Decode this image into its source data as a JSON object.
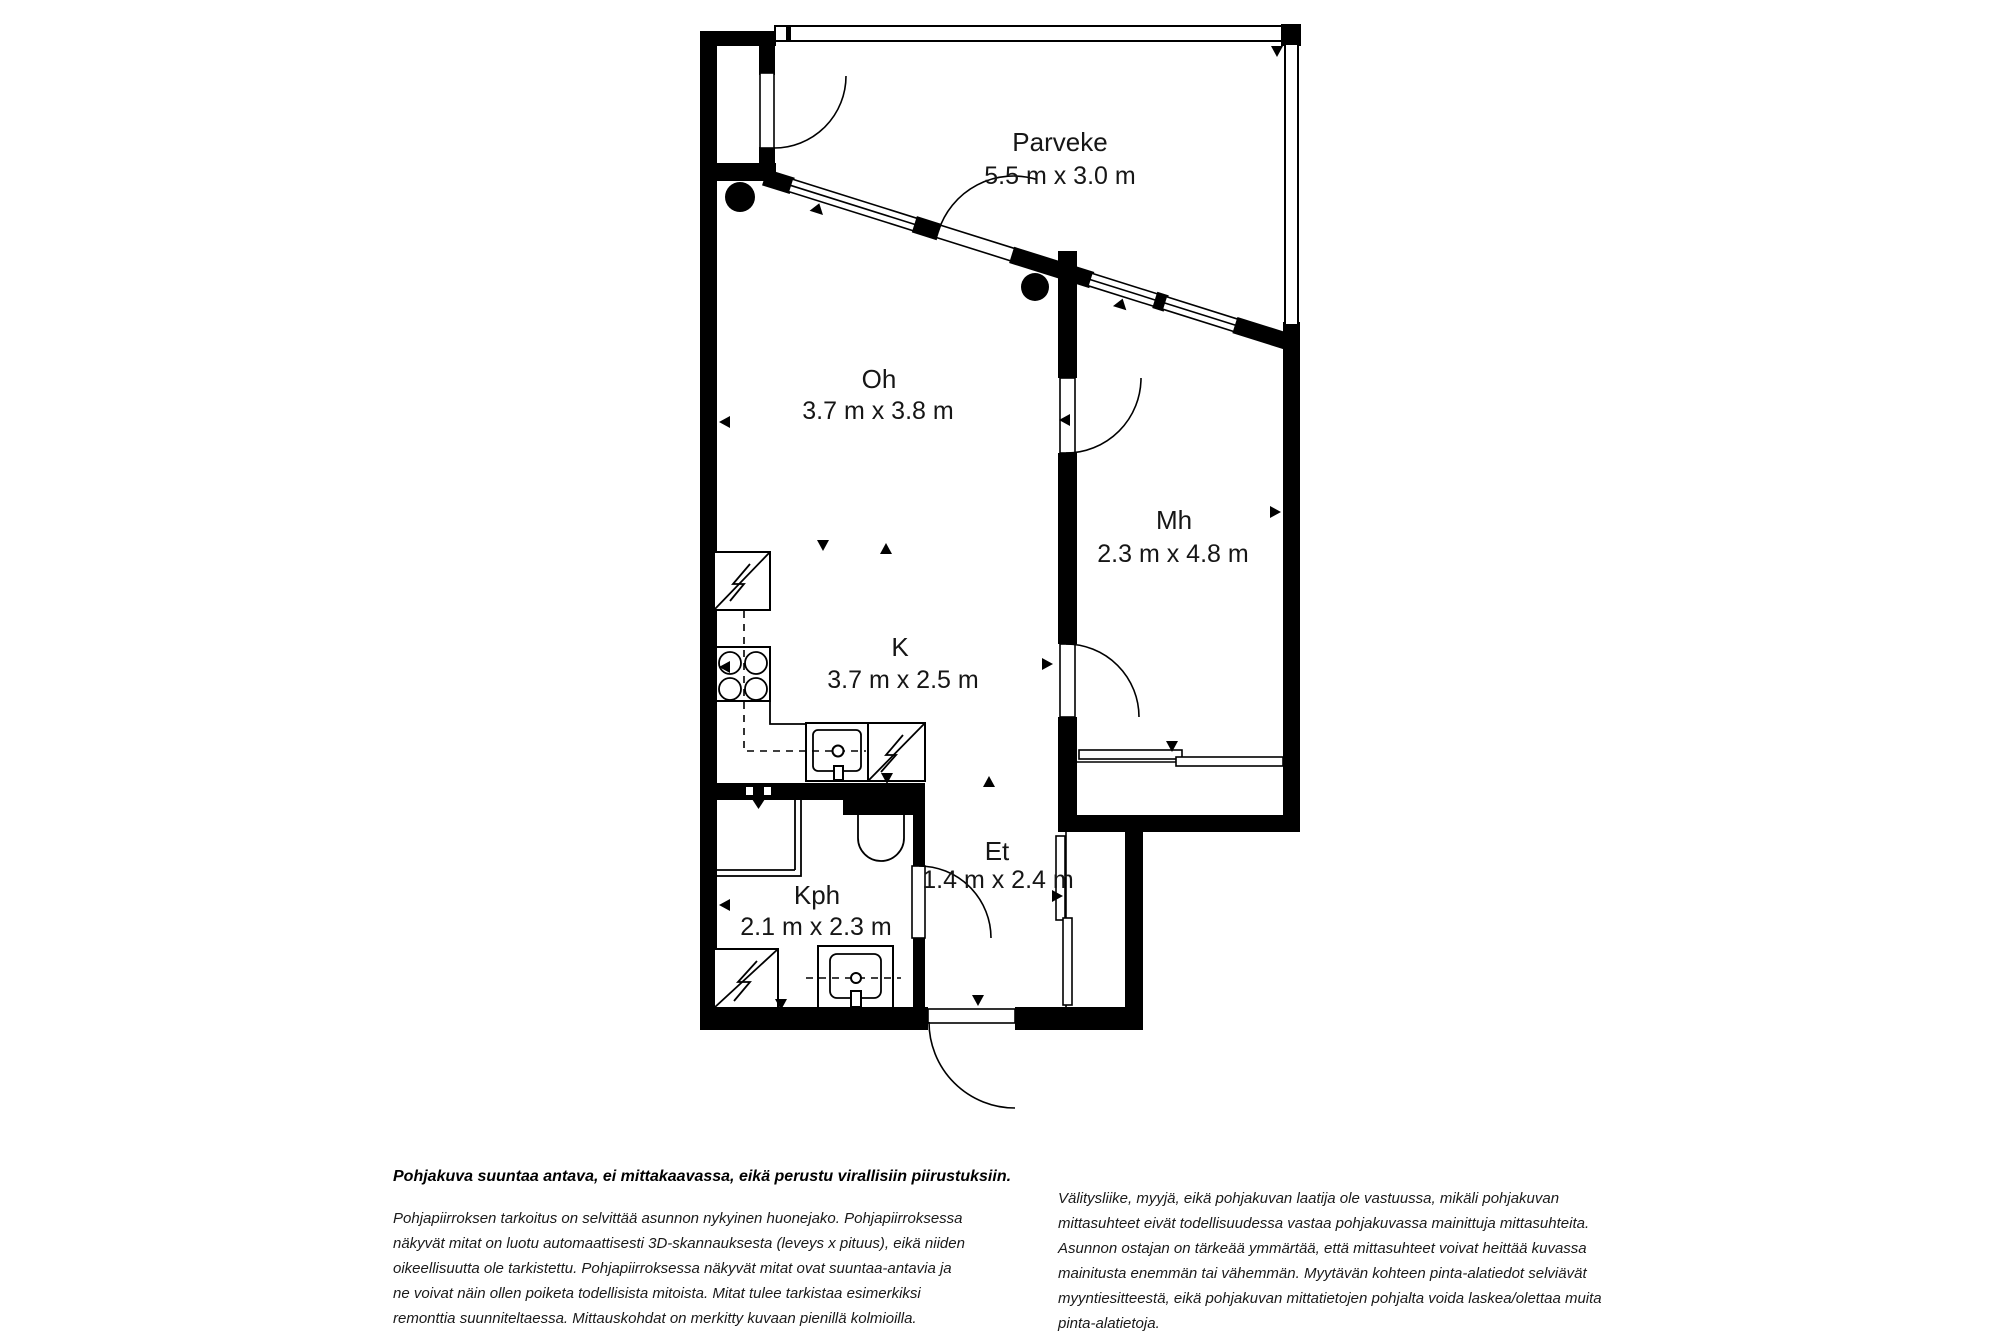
{
  "floorplan": {
    "rooms": [
      {
        "name": "Parveke",
        "dims": "5.5 m x 3.0 m"
      },
      {
        "name": "Oh",
        "dims": "3.7 m x 3.8 m"
      },
      {
        "name": "Mh",
        "dims": "2.3 m x 4.8 m"
      },
      {
        "name": "K",
        "dims": "3.7 m x 2.5 m"
      },
      {
        "name": "Et",
        "dims": "1.4 m x 2.4 m"
      },
      {
        "name": "Kph",
        "dims": "2.1 m x 2.3 m"
      }
    ],
    "fixtures": [
      "fridge-icon",
      "stove-icon",
      "kitchen-sink-icon",
      "dishwasher-icon",
      "shower-icon",
      "toilet-icon",
      "washing-machine-icon",
      "bathroom-sink-icon",
      "sliding-wardrobe-icon",
      "door-swing-icon",
      "window-icon",
      "measurement-triangle-icon",
      "measurement-dot-icon"
    ],
    "colors": {
      "wall": "#000000",
      "background": "#ffffff",
      "text": "#161616"
    }
  },
  "disclaimer": {
    "headline": "Pohjakuva suuntaa antava, ei mittakaavassa, eikä perustu virallisiin piirustuksiin.",
    "left_lines": [
      "Pohjapiirroksen tarkoitus on selvittää asunnon nykyinen huonejako. Pohjapiirroksessa",
      "näkyvät mitat on luotu automaattisesti 3D-skannauksesta (leveys x pituus), eikä niiden",
      "oikeellisuutta ole tarkistettu. Pohjapiirroksessa näkyvät mitat ovat suuntaa-antavia ja",
      "ne voivat näin ollen poiketa todellisista mitoista. Mitat tulee tarkistaa esimerkiksi",
      "remonttia suunniteltaessa. Mittauskohdat on merkitty kuvaan pienillä kolmioilla."
    ],
    "right_lines": [
      "Välitysliike, myyjä, eikä pohjakuvan laatija ole vastuussa, mikäli pohjakuvan",
      "mittasuhteet eivät todellisuudessa vastaa pohjakuvassa mainittuja mittasuhteita.",
      "Asunnon ostajan on tärkeää ymmärtää, että mittasuhteet voivat heittää kuvassa",
      "mainitusta enemmän tai vähemmän. Myytävän kohteen pinta-alatiedot selviävät",
      "myyntiesitteestä, eikä pohjakuvan mittatietojen pohjalta voida laskea/olettaa muita",
      "pinta-alatietoja."
    ]
  }
}
